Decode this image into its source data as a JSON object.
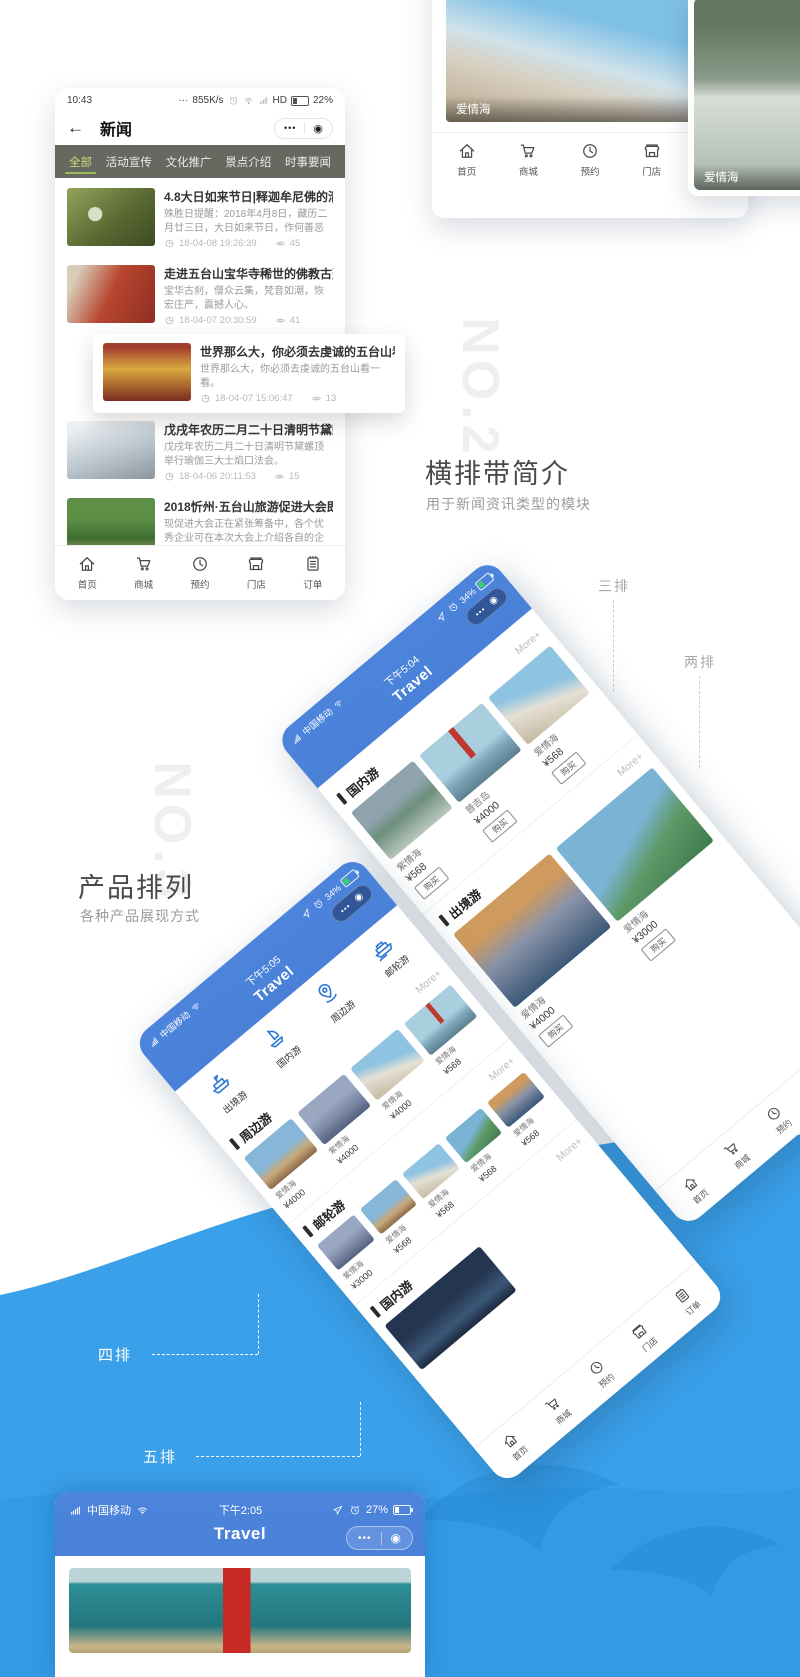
{
  "watermarks": {
    "no2": "NO.2",
    "no3": "NO.3"
  },
  "section_headings": {
    "no2": {
      "title": "横排带简介",
      "subtitle": "用于新闻资讯类型的模块"
    },
    "no3": {
      "title": "产品排列",
      "subtitle": "各种产品展现方式"
    }
  },
  "callouts": {
    "three": "三排",
    "two": "两排",
    "four": "四排",
    "five": "五排"
  },
  "tabbar": {
    "items": [
      {
        "label": "首页",
        "icon": "home"
      },
      {
        "label": "商城",
        "icon": "cart"
      },
      {
        "label": "预约",
        "icon": "clock"
      },
      {
        "label": "门店",
        "icon": "store"
      },
      {
        "label": "订单",
        "icon": "order"
      }
    ]
  },
  "news_phone": {
    "status": {
      "time": "10:43",
      "dots": "···",
      "net_speed": "855K/s",
      "hd": "HD",
      "battery": "22%"
    },
    "nav": {
      "back": "←",
      "title": "新闻",
      "menu_dots": "•••",
      "target": "◉"
    },
    "tabs": [
      "全部",
      "活动宣传",
      "文化推广",
      "景点介绍",
      "时事要闻"
    ],
    "items": [
      {
        "title": "4.8大日如来节日|释迦牟尼佛的清净报",
        "desc": "殊胜日提醒：2018年4月8日，藏历二月廿三日，大日如来节日，作何善恶成亿倍…",
        "time": "18-04-08 19:26:39",
        "views": "45"
      },
      {
        "title": "走进五台山宝华寺稀世的佛教古建筑",
        "desc": "宝华古刹，僧众云集，梵音如潮，恢宏庄严，震撼人心。",
        "time": "18-04-07 20:30:59",
        "views": "41"
      },
      {
        "title": "世界那么大，你必须去虔诚的五台山看",
        "desc": "世界那么大，你必须去虔诚的五台山看一看。",
        "time": "18-04-07 15:06:47",
        "views": "13"
      },
      {
        "title": "戊戌年农历二月二十日清明节黛螺顶举",
        "desc": "戊戌年农历二月二十日清明节黛螺顶举行瑜伽三大士焰口法会。",
        "time": "18-04-06 20:11:53",
        "views": "15"
      },
      {
        "title": "2018忻州·五台山旅游促进大会即将召",
        "desc": "现促进大会正在紧张筹备中，各个优秀企业可在本次大会上介绍各自的企业文化等，",
        "time": "18-04-06 10:42:36",
        "views": "61"
      }
    ]
  },
  "gallery_phone": {
    "cards": [
      {
        "caption": "爱情海"
      },
      {
        "caption": "爱情海"
      }
    ]
  },
  "travel_a": {
    "carrier": "中国移动",
    "time": "下午5:04",
    "battery": "34%",
    "title": "Travel",
    "menu_dots": "•••",
    "target": "◉",
    "more_label": "More+",
    "sections": [
      {
        "name": "国内游",
        "products": [
          {
            "name": "紫情海",
            "price": "¥568",
            "btn": "购买"
          },
          {
            "name": "普吉岛",
            "price": "¥4000",
            "btn": "购买"
          },
          {
            "name": "爱情海",
            "price": "¥568",
            "btn": "购买"
          }
        ]
      },
      {
        "name": "出境游",
        "products": [
          {
            "name": "爱情海",
            "price": "¥4000",
            "btn": "购买"
          },
          {
            "name": "爱情海",
            "price": "¥3000",
            "btn": "购买"
          }
        ]
      }
    ]
  },
  "travel_b": {
    "carrier": "中国移动",
    "time": "下午5:05",
    "battery": "34%",
    "title": "Travel",
    "menu_dots": "•••",
    "target": "◉",
    "more_label": "More+",
    "categories": [
      {
        "label": "出境游",
        "icon": "ship"
      },
      {
        "label": "国内游",
        "icon": "raft"
      },
      {
        "label": "周边游",
        "icon": "pin"
      },
      {
        "label": "邮轮游",
        "icon": "cruise"
      }
    ],
    "sections": [
      {
        "name": "周边游",
        "products": [
          {
            "name": "爱情海",
            "price": "¥4000"
          },
          {
            "name": "紫情海",
            "price": "¥4000"
          },
          {
            "name": "爱情海",
            "price": "¥4000"
          },
          {
            "name": "爱情海",
            "price": "¥568"
          }
        ]
      },
      {
        "name": "邮轮游",
        "products": [
          {
            "name": "紫情海",
            "price": "¥3000"
          },
          {
            "name": "爱情海",
            "price": "¥568"
          },
          {
            "name": "爱情海",
            "price": "¥568"
          },
          {
            "name": "爱情海",
            "price": "¥568"
          },
          {
            "name": "爱情海",
            "price": "¥568"
          }
        ]
      },
      {
        "name": "国内游",
        "products": []
      }
    ]
  },
  "phone_c": {
    "carrier": "中国移动",
    "time": "下午2:05",
    "battery": "27%",
    "title": "Travel",
    "menu_dots": "•••",
    "target": "◉"
  }
}
